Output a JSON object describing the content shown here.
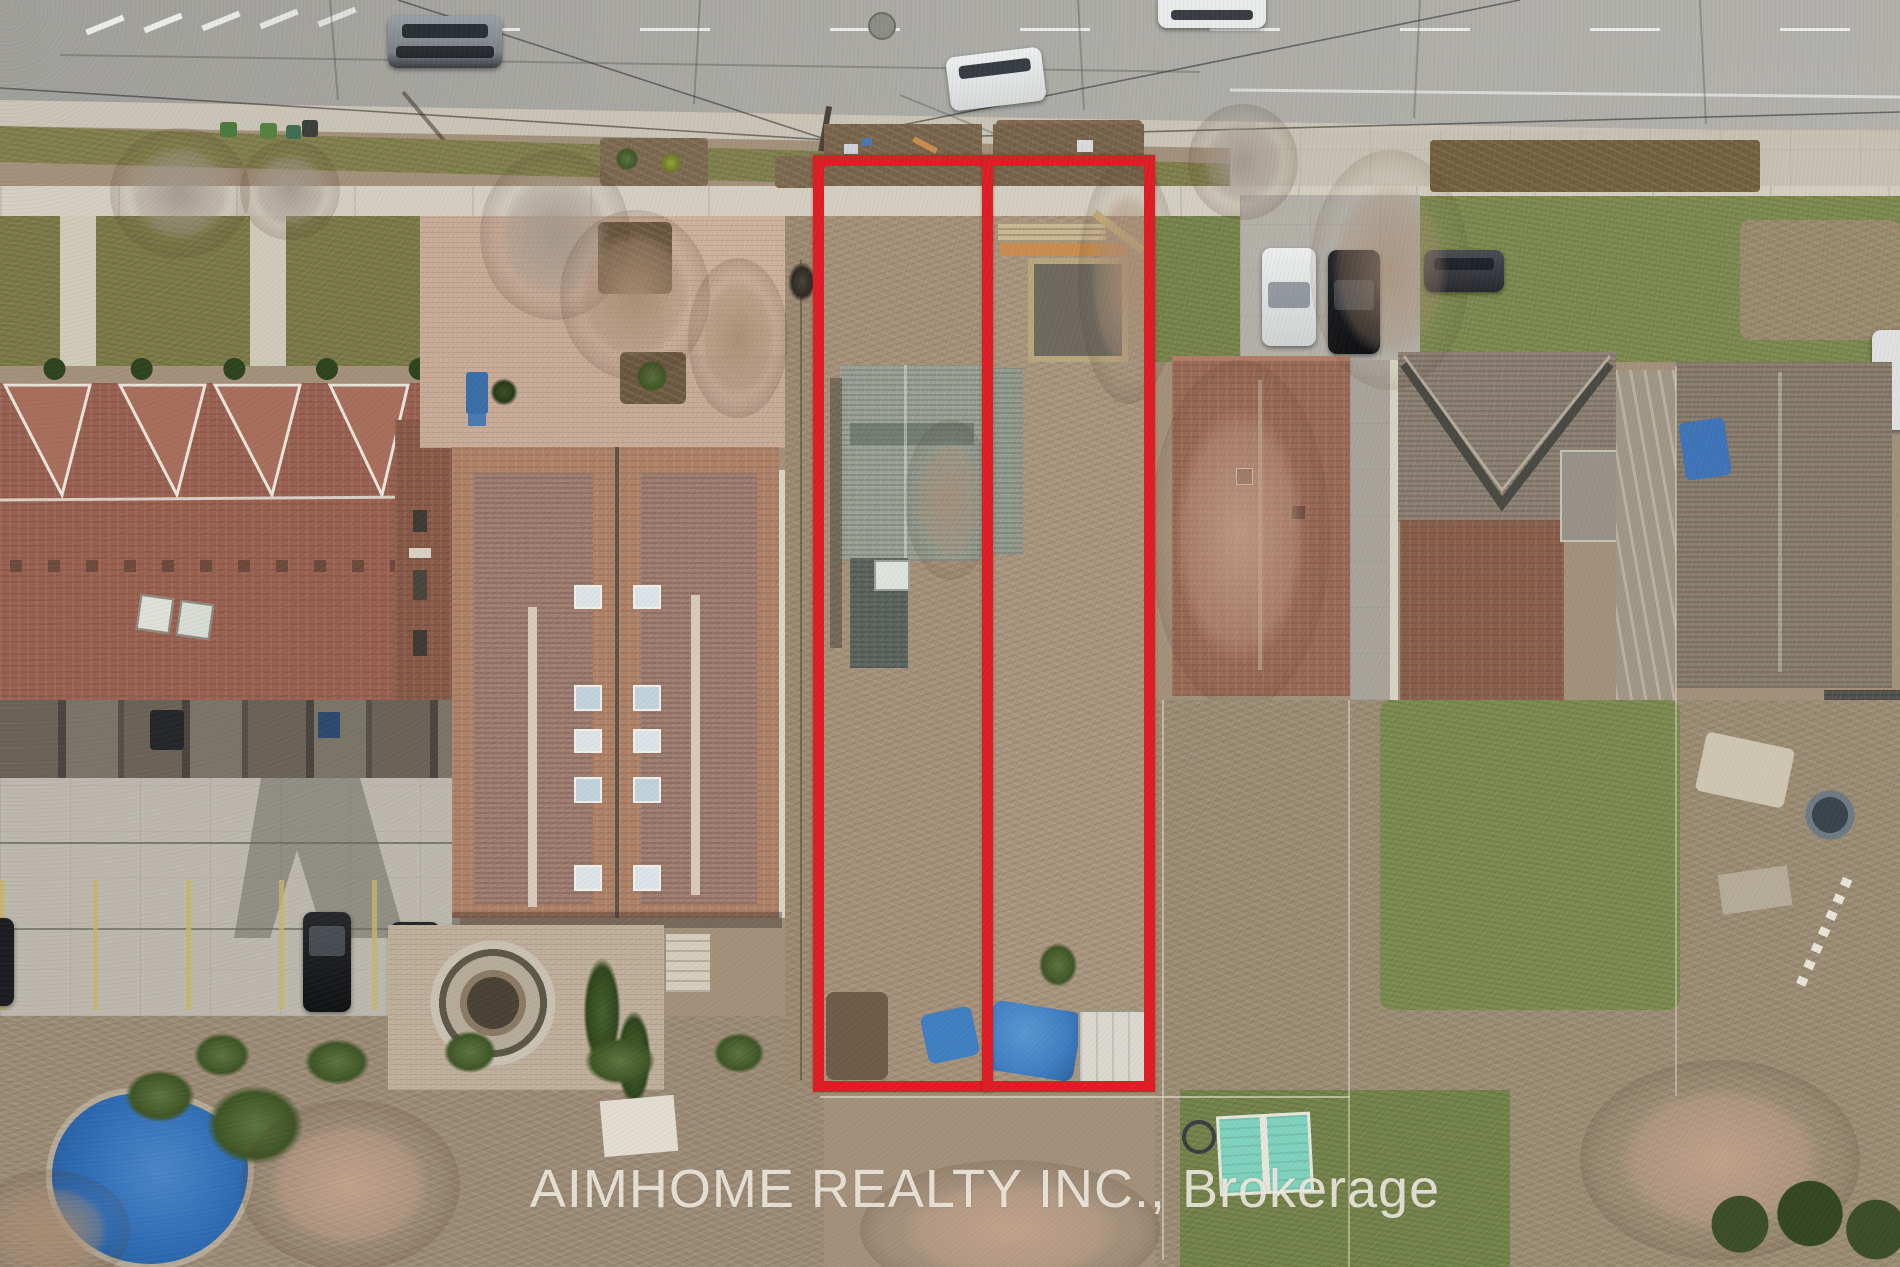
{
  "image": {
    "type": "aerial-drone-photo",
    "description": "Overhead aerial photo of a residential street; two adjacent narrow vacant lots outlined in red between houses",
    "watermark": {
      "text": "AIMHOME REALTY INC., Brokerage",
      "color": "#f5f0e5"
    },
    "annotation": {
      "lot_outline_color": "#de1d24",
      "lots": [
        {
          "label": "left-lot",
          "contains": "house with gray-green roof, scrub yard, blue tarps"
        },
        {
          "label": "right-lot",
          "contains": "construction lumber, dug pit, blue tarp pile, white shed"
        }
      ]
    },
    "palette": {
      "road": "#a6a5a0",
      "curb_gutter": "#c9c4b6",
      "sidewalk": "#d3cec0",
      "boulevard_grass": "#83804f",
      "lawn": "#7e8b52",
      "scrub": "#a6917a",
      "townhouse_roof": "#9a6150",
      "apartment_roof": "#a58275",
      "gray_house_roof": "#9aa195",
      "right_house_roof": "#9b6a56",
      "parking_concrete": "#bcb8ae",
      "pool_blue": "#2f6cb4",
      "tarp_blue": "#3f7fc2",
      "teal_shed": "#7fd2bd",
      "car_dark": "#17191d",
      "car_white": "#e9eaea",
      "car_silver": "#9aa0a6"
    }
  }
}
